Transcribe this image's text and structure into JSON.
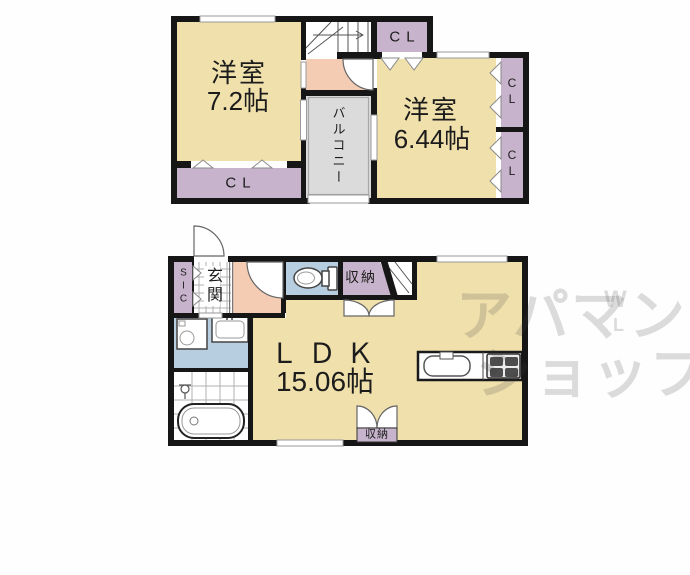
{
  "colors": {
    "wall": "#161616",
    "room": "#F0E0AC",
    "closet": "#C7B4CC",
    "balcony": "#DBDBDB",
    "hallway": "#F4CCB4",
    "wet": "#B6CEDF",
    "label": "#1c1c1c",
    "watermark": "rgba(60,60,60,0.18)"
  },
  "floor2": {
    "room_west": {
      "name": "洋室",
      "area": "7.2帖"
    },
    "room_east": {
      "name": "洋室",
      "area": "6.44帖"
    },
    "closet_top": "CL",
    "closet_west": "CL",
    "closet_east_upper": "CL",
    "closet_east_lower": "CL",
    "balcony": "バルコニー"
  },
  "floor1": {
    "shoe_closet": "SIC",
    "entrance": "玄関",
    "storage_hall": "収納",
    "storage_south": "収納",
    "ldk": {
      "name": "ＬＤＫ",
      "area": "15.06帖"
    }
  },
  "watermark": {
    "line1": "アパマン",
    "line2": "ショップ",
    "mark_top": "W",
    "mark_bottom": "L"
  }
}
